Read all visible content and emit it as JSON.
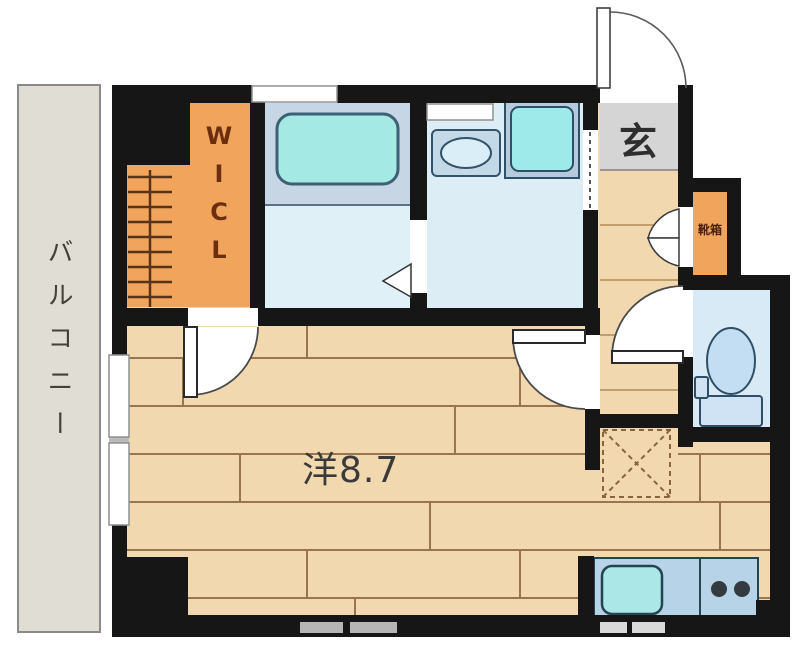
{
  "floorplan": {
    "labels": {
      "balcony": "バルコニー",
      "walk_in_closet": "WICL",
      "entrance": "玄",
      "shoe_box": "靴箱",
      "main_room": "洋8.7"
    },
    "colors": {
      "wall": "#161616",
      "wood_floor": "#f2d8ae",
      "plank_line": "#9a7450",
      "balcony_floor": "#e0ddd5",
      "closet_orange": "#f0a45c",
      "bathroom_platform": "#c6d6e4",
      "bathroom_floor": "#dff0f6",
      "washroom_floor": "#ddedf5",
      "toilet_floor": "#d9eaf7",
      "entrance_tile": "#d5d5d5",
      "tub_cyan": "#a5e9e4",
      "counter_blue": "#b7d3e8",
      "fixture_outline": "#2f4f66"
    }
  }
}
